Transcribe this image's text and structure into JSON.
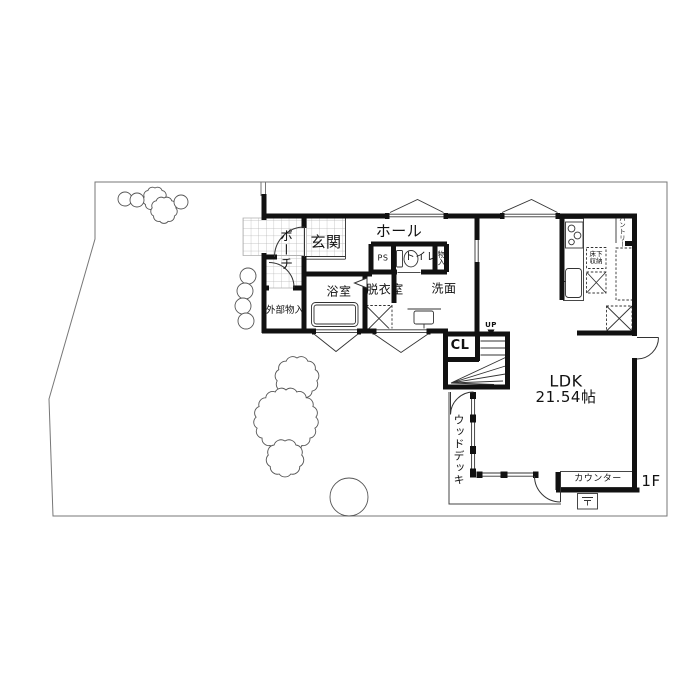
{
  "floorplan": {
    "floor_badge": "1F",
    "labels": {
      "porch": "ポーチ",
      "entrance": "玄関",
      "hall": "ホール",
      "ps": "PS",
      "toilet": "トイレ",
      "storage_small": "物入",
      "bathroom": "浴室",
      "dressing_room": "脱衣室",
      "washroom": "洗面",
      "exterior_storage": "外部物入",
      "closet": "CL",
      "up": "UP",
      "ldk": "LDK",
      "ldk_area": "21.54帖",
      "wood_deck": "ウッドデッキ",
      "counter": "カウンター",
      "underfloor_storage": "床下収納",
      "pantry": "パントリー"
    },
    "colors": {
      "wall_ink": "#111111",
      "fixture_line": "#333333",
      "site_line": "#777777"
    }
  }
}
